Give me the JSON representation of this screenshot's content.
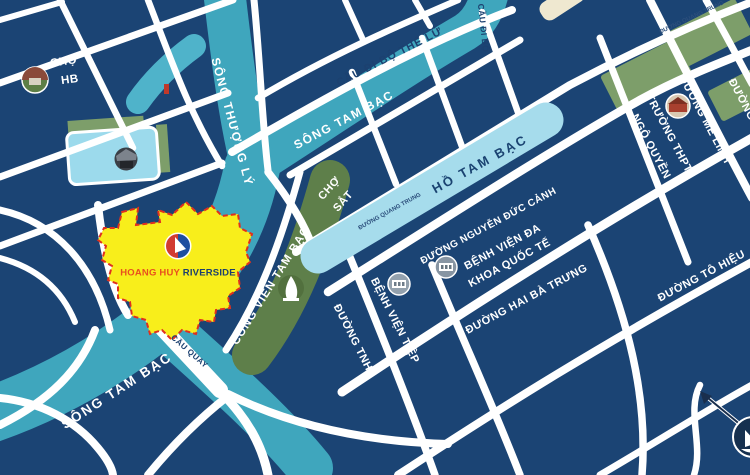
{
  "map": {
    "title": "Hoang Huy Riverside location map",
    "project": {
      "name_part1": "HOANG HUY",
      "name_part2": " RIVERSIDE",
      "area_color": "#f8ee1b",
      "border_color": "#e0301e",
      "logo": "sail-circle-logo"
    },
    "colors": {
      "block": "#1b4474",
      "road": "#ffffff",
      "river": "#3fa6bd",
      "lake": "#a6dcec",
      "pond": "#9cdaec",
      "park_dark": "#5e7f4a",
      "park_light": "#7d9e6a"
    },
    "icons": [
      {
        "name": "market-icon",
        "for": "CHỢ HB"
      },
      {
        "name": "building-icon",
        "for": "pond building"
      },
      {
        "name": "statue-icon",
        "for": "CÔNG VIÊN TAM BẠC"
      },
      {
        "name": "hospital-icon",
        "for": "BỆNH VIỆN TIỆP"
      },
      {
        "name": "hospital-icon-2",
        "for": "BỆNH VIỆN ĐA KHOA QUỐC TẾ"
      },
      {
        "name": "school-icon",
        "for": "TRƯỜNG THPT NGÔ QUYỀN"
      },
      {
        "name": "compass-icon",
        "for": "map orientation"
      }
    ],
    "labels": [
      {
        "name": "label-cho-hb",
        "text": "CHỢ",
        "x": 64,
        "y": 62,
        "rot": -8,
        "cls": "blockw md"
      },
      {
        "name": "label-cho-hb-2",
        "text": "HB",
        "x": 70,
        "y": 80,
        "rot": -8,
        "cls": "blockw md"
      },
      {
        "name": "label-song-thuong-ly",
        "text": "SÔNG THƯỢNG LÝ",
        "x": 232,
        "y": 122,
        "rot": 75,
        "cls": "river"
      },
      {
        "name": "label-cau-di-bo-the-lu",
        "text": "CẦU ĐI BỘ THẾ LỮ",
        "x": 390,
        "y": 58,
        "rot": -27,
        "cls": "roadnavy"
      },
      {
        "name": "label-song-tam-bac-top",
        "text": "SÔNG TAM BẠC",
        "x": 344,
        "y": 120,
        "rot": -28,
        "cls": "river"
      },
      {
        "name": "label-cau-di-bo",
        "text": "CẦU ĐI BỘ",
        "x": 483,
        "y": 28,
        "rot": 84,
        "cls": "roadnavy sm"
      },
      {
        "name": "label-duong-quang-trung-2",
        "text": "ĐƯỜNG QUANG TRUNG",
        "x": 692,
        "y": 18,
        "rot": -25,
        "cls": "tiny"
      },
      {
        "name": "label-ho-tam-bac",
        "text": "HỒ TAM BẠC",
        "x": 480,
        "y": 164,
        "rot": -29,
        "cls": "lake"
      },
      {
        "name": "label-cho-sat",
        "text": "CHỢ",
        "x": 330,
        "y": 189,
        "rot": -48,
        "cls": "blockw"
      },
      {
        "name": "label-cho-sat-2",
        "text": "SẮT",
        "x": 344,
        "y": 202,
        "rot": -48,
        "cls": "blockw"
      },
      {
        "name": "label-duong-quang-trung",
        "text": "ĐƯỜNG QUANG TRUNG",
        "x": 390,
        "y": 212,
        "rot": -29,
        "cls": "tiny"
      },
      {
        "name": "label-duong-nguyen-duc-canh",
        "text": "ĐƯỜNG NGUYỄN ĐỨC CẢNH",
        "x": 489,
        "y": 227,
        "rot": -28,
        "cls": "blockw sm2"
      },
      {
        "name": "label-benh-vien-da",
        "text": "BỆNH VIỆN ĐA",
        "x": 503,
        "y": 248,
        "rot": -28,
        "cls": "blockw"
      },
      {
        "name": "label-khoa-quoc-te",
        "text": "KHOA QUỐC TẾ",
        "x": 510,
        "y": 264,
        "rot": -28,
        "cls": "blockw"
      },
      {
        "name": "label-duong-hai-ba-trung",
        "text": "ĐƯỜNG HAI BÀ TRƯNG",
        "x": 527,
        "y": 300,
        "rot": -28,
        "cls": "blockw"
      },
      {
        "name": "label-truong-thpt",
        "text": "TRƯỜNG THPT",
        "x": 668,
        "y": 134,
        "rot": 62,
        "cls": "blockw"
      },
      {
        "name": "label-ngo-quyen",
        "text": "NGÔ QUYỀN",
        "x": 650,
        "y": 147,
        "rot": 62,
        "cls": "blockw"
      },
      {
        "name": "label-duong-me-linh",
        "text": "ĐƯỜNG MÊ LINH",
        "x": 704,
        "y": 120,
        "rot": 62,
        "cls": "blockw"
      },
      {
        "name": "label-duong-edge",
        "text": "ĐƯỜNG",
        "x": 741,
        "y": 100,
        "rot": 62,
        "cls": "blockw"
      },
      {
        "name": "label-duong-to-hieu",
        "text": "ĐƯỜNG TÔ HIỆU",
        "x": 702,
        "y": 277,
        "rot": -28,
        "cls": "blockw"
      },
      {
        "name": "label-cong-vien-tam-bac",
        "text": "CÔNG VIÊN TAM BẠC",
        "x": 271,
        "y": 286,
        "rot": -58,
        "cls": "park"
      },
      {
        "name": "label-benh-vien-tiep",
        "text": "BỆNH VIỆN TIỆP",
        "x": 394,
        "y": 321,
        "rot": 63,
        "cls": "blockw"
      },
      {
        "name": "label-duong-tnh",
        "text": "ĐƯỜNG TNH",
        "x": 352,
        "y": 338,
        "rot": 63,
        "cls": "blockw"
      },
      {
        "name": "label-song-tam-bac-bottom",
        "text": "SÔNG TAM BẠC",
        "x": 117,
        "y": 391,
        "rot": -33,
        "cls": "river lg"
      },
      {
        "name": "label-cau-quay",
        "text": "CẦU QUAY",
        "x": 189,
        "y": 352,
        "rot": 41,
        "cls": "roadnavy xs"
      }
    ]
  }
}
